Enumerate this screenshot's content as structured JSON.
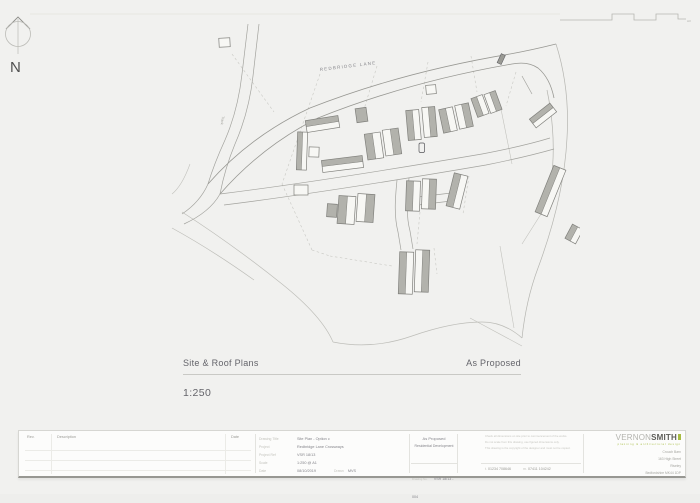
{
  "north_arrow": {
    "label": "N"
  },
  "sheet": {
    "size_mark": "A3"
  },
  "site_plan": {
    "road_label": "REDBRIDGE  LANE",
    "track_label": "Track"
  },
  "caption": {
    "drawing_title": "Site & Roof Plans",
    "status": "As Proposed",
    "scale": "1:250"
  },
  "title_block": {
    "revision_table": {
      "headers": [
        "Rev.",
        "Description",
        "Date"
      ]
    },
    "fields": [
      {
        "label": "Drawing Title",
        "value": "Site Plan - Option c"
      },
      {
        "label": "Project",
        "value": "Redbridge Lane Crossways"
      },
      {
        "label": "Project Ref",
        "value": "VSR 18/13"
      },
      {
        "label": "Scale",
        "value": "1:250 @ A1"
      },
      {
        "label": "Date",
        "value": "08/10/2019"
      }
    ],
    "drawn_label": "Drawn",
    "drawn_value": "MVS",
    "status": "As Proposed",
    "development_type": "Residential Development",
    "drawing_no_label": "Drawing No.",
    "drawing_no": "VSR 18/13 - 004",
    "notes": [
      "Check all dimensions on site prior to commencement of the works.",
      "Do not scale from this drawing, use figured dimensions only.",
      "This drawing is the copyright of the designer and must not be copied."
    ],
    "contact": {
      "tel_label": "t.",
      "tel": "01234 708646",
      "mob_label": "m.",
      "mob": "07411 104242"
    },
    "firm": {
      "name_light": "VERNON",
      "name_bold": "SMITH",
      "tagline": "planning & architectural design",
      "accent_color": "#a7bc42",
      "address_lines": [
        "Crouch Barn",
        "163 High Street",
        "Riseley",
        "Bedfordshire MK44 1DP"
      ]
    }
  }
}
